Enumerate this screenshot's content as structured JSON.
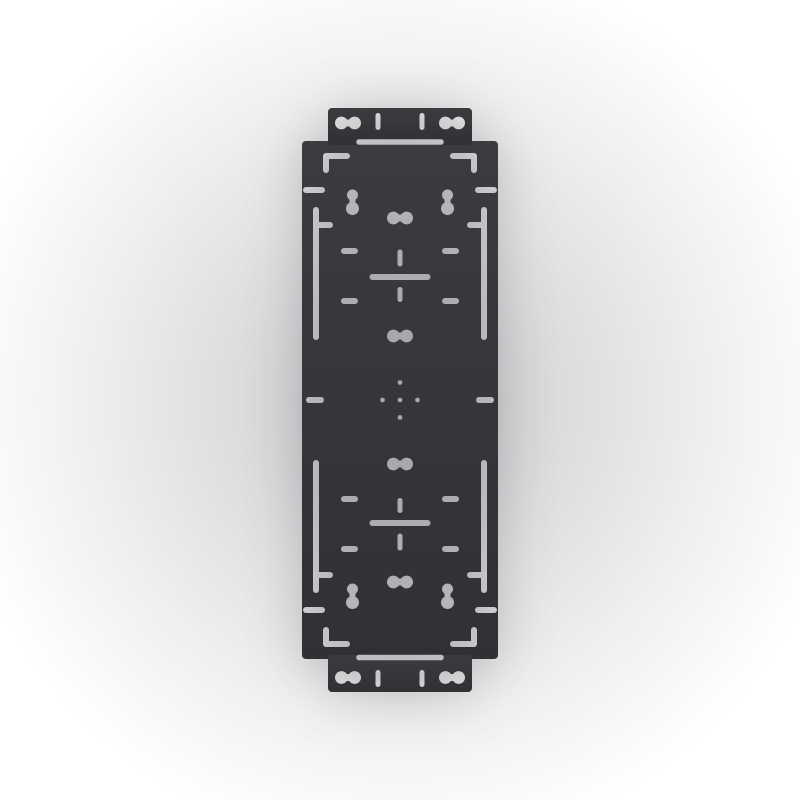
{
  "scene": {
    "description": "Product image of a dark gray rectangular mounting plate with narrow tabs at top and bottom, lying flat on a light studio backdrop; the plate has slotted dog-bone cutouts, keyhole slots, corner L-shaped marks, dashed alignment slots, two cross-shaped alignment cutouts and a central cluster of five small holes",
    "visible_text": ""
  },
  "colors": {
    "plate_top": "#3b3c40",
    "plate_bottom": "#303134",
    "backdrop_center": "#d0d1d2",
    "backdrop_edge": "#ffffff"
  },
  "plate": {
    "canvas": {
      "width": 800,
      "height": 800
    },
    "body": {
      "x": 302,
      "y": 141,
      "w": 196,
      "h": 518,
      "rx": 4
    },
    "tab_top": {
      "x": 328,
      "y": 108,
      "w": 144,
      "h": 37,
      "rx": 4
    },
    "tab_bottom": {
      "x": 328,
      "y": 655,
      "w": 144,
      "h": 37,
      "rx": 4
    },
    "hole_params": {
      "dogbone": {
        "span": 6.6,
        "r": 6.4,
        "neck": 7
      },
      "keyhole": {
        "r_top": 5.5,
        "r_bot": 6.5,
        "neck": 6
      }
    },
    "holes": [
      {
        "name": "tab-top-slot-left",
        "type": "dogbone-h",
        "cx": 348,
        "cy": 123
      },
      {
        "name": "tab-top-slot-right",
        "type": "dogbone-h",
        "cx": 452,
        "cy": 123
      },
      {
        "name": "tab-top-notch-left",
        "type": "line",
        "x1": 378,
        "y1": 115.5,
        "x2": 378,
        "y2": 127.5,
        "w": 5
      },
      {
        "name": "tab-top-notch-right",
        "type": "line",
        "x1": 422,
        "y1": 115.5,
        "x2": 422,
        "y2": 127.5,
        "w": 5
      },
      {
        "name": "top-junction-slot",
        "type": "line",
        "x1": 359,
        "y1": 142,
        "x2": 441,
        "y2": 142,
        "w": 5.5
      },
      {
        "name": "corner-mark-top-left",
        "type": "polyline",
        "points": [
          [
            347,
            156
          ],
          [
            326,
            156
          ],
          [
            326,
            170
          ]
        ],
        "w": 6
      },
      {
        "name": "corner-mark-top-right",
        "type": "polyline",
        "points": [
          [
            453,
            156
          ],
          [
            474,
            156
          ],
          [
            474,
            170
          ]
        ],
        "w": 6
      },
      {
        "name": "edge-dash-top-left",
        "type": "line",
        "x1": 306,
        "y1": 190,
        "x2": 322,
        "y2": 190,
        "w": 6
      },
      {
        "name": "edge-dash-top-right",
        "type": "line",
        "x1": 478,
        "y1": 190,
        "x2": 494,
        "y2": 190,
        "w": 6
      },
      {
        "name": "keyhole-top-left",
        "type": "keyhole",
        "cx": 352.5,
        "y_top": 195,
        "y_bot": 208.5
      },
      {
        "name": "keyhole-top-right",
        "type": "keyhole",
        "cx": 447.5,
        "y_top": 195,
        "y_bot": 208.5
      },
      {
        "name": "center-slot-1",
        "type": "dogbone-h",
        "cx": 400,
        "cy": 218
      },
      {
        "name": "side-slot-top-left",
        "type": "line",
        "x1": 316,
        "y1": 210,
        "x2": 316,
        "y2": 337,
        "w": 6
      },
      {
        "name": "side-slot-top-right",
        "type": "line",
        "x1": 484,
        "y1": 210,
        "x2": 484,
        "y2": 337,
        "w": 6
      },
      {
        "name": "side-branch-top-left",
        "type": "line",
        "x1": 316,
        "y1": 225,
        "x2": 330,
        "y2": 225,
        "w": 6
      },
      {
        "name": "side-branch-top-right",
        "type": "line",
        "x1": 470,
        "y1": 225,
        "x2": 484,
        "y2": 225,
        "w": 6
      },
      {
        "name": "dash-row1-left",
        "type": "line",
        "x1": 344,
        "y1": 251,
        "x2": 355,
        "y2": 251,
        "w": 6
      },
      {
        "name": "dash-row1-right",
        "type": "line",
        "x1": 445,
        "y1": 251,
        "x2": 456,
        "y2": 251,
        "w": 6
      },
      {
        "name": "cross-top-vertical-upper",
        "type": "line",
        "x1": 400,
        "y1": 252,
        "x2": 400,
        "y2": 264,
        "w": 5
      },
      {
        "name": "cross-top-horizontal",
        "type": "line",
        "x1": 372.5,
        "y1": 277,
        "x2": 427.5,
        "y2": 277,
        "w": 6
      },
      {
        "name": "cross-top-vertical-lower",
        "type": "line",
        "x1": 400,
        "y1": 289.5,
        "x2": 400,
        "y2": 299.5,
        "w": 5
      },
      {
        "name": "dash-row2-left",
        "type": "line",
        "x1": 344,
        "y1": 301,
        "x2": 355,
        "y2": 301,
        "w": 6
      },
      {
        "name": "dash-row2-right",
        "type": "line",
        "x1": 445,
        "y1": 301,
        "x2": 456,
        "y2": 301,
        "w": 6
      },
      {
        "name": "center-slot-2",
        "type": "dogbone-h",
        "cx": 400,
        "cy": 336
      },
      {
        "name": "edge-dash-mid-left",
        "type": "line",
        "x1": 309,
        "y1": 400,
        "x2": 321,
        "y2": 400,
        "w": 6
      },
      {
        "name": "edge-dash-mid-right",
        "type": "line",
        "x1": 479,
        "y1": 400,
        "x2": 491,
        "y2": 400,
        "w": 6
      },
      {
        "name": "center-dots",
        "type": "dots",
        "cx": 400,
        "cy": 400,
        "offset": 17.5,
        "r": 2.4
      },
      {
        "name": "center-slot-3",
        "type": "dogbone-h",
        "cx": 400,
        "cy": 464
      },
      {
        "name": "side-slot-bottom-left",
        "type": "line",
        "x1": 316,
        "y1": 463,
        "x2": 316,
        "y2": 590,
        "w": 6
      },
      {
        "name": "side-slot-bottom-right",
        "type": "line",
        "x1": 484,
        "y1": 463,
        "x2": 484,
        "y2": 590,
        "w": 6
      },
      {
        "name": "side-branch-bottom-left",
        "type": "line",
        "x1": 316,
        "y1": 575,
        "x2": 330,
        "y2": 575,
        "w": 6
      },
      {
        "name": "side-branch-bottom-right",
        "type": "line",
        "x1": 470,
        "y1": 575,
        "x2": 484,
        "y2": 575,
        "w": 6
      },
      {
        "name": "dash-row3-left",
        "type": "line",
        "x1": 344,
        "y1": 499,
        "x2": 355,
        "y2": 499,
        "w": 6
      },
      {
        "name": "dash-row3-right",
        "type": "line",
        "x1": 445,
        "y1": 499,
        "x2": 456,
        "y2": 499,
        "w": 6
      },
      {
        "name": "cross-bottom-vertical-upper",
        "type": "line",
        "x1": 400,
        "y1": 500.5,
        "x2": 400,
        "y2": 510.5,
        "w": 5
      },
      {
        "name": "cross-bottom-horizontal",
        "type": "line",
        "x1": 372.5,
        "y1": 523,
        "x2": 427.5,
        "y2": 523,
        "w": 6
      },
      {
        "name": "cross-bottom-vertical-lower",
        "type": "line",
        "x1": 400,
        "y1": 536,
        "x2": 400,
        "y2": 548,
        "w": 5
      },
      {
        "name": "dash-row4-left",
        "type": "line",
        "x1": 344,
        "y1": 549,
        "x2": 355,
        "y2": 549,
        "w": 6
      },
      {
        "name": "dash-row4-right",
        "type": "line",
        "x1": 445,
        "y1": 549,
        "x2": 456,
        "y2": 549,
        "w": 6
      },
      {
        "name": "center-slot-4",
        "type": "dogbone-h",
        "cx": 400,
        "cy": 582
      },
      {
        "name": "keyhole-bottom-left",
        "type": "keyhole",
        "cx": 352.5,
        "y_top": 589,
        "y_bot": 602.5
      },
      {
        "name": "keyhole-bottom-right",
        "type": "keyhole",
        "cx": 447.5,
        "y_top": 589,
        "y_bot": 602.5
      },
      {
        "name": "edge-dash-bottom-left",
        "type": "line",
        "x1": 306,
        "y1": 610,
        "x2": 322,
        "y2": 610,
        "w": 6
      },
      {
        "name": "edge-dash-bottom-right",
        "type": "line",
        "x1": 478,
        "y1": 610,
        "x2": 494,
        "y2": 610,
        "w": 6
      },
      {
        "name": "corner-mark-bottom-left",
        "type": "polyline",
        "points": [
          [
            347,
            644
          ],
          [
            326,
            644
          ],
          [
            326,
            630
          ]
        ],
        "w": 6
      },
      {
        "name": "corner-mark-bottom-right",
        "type": "polyline",
        "points": [
          [
            453,
            644
          ],
          [
            474,
            644
          ],
          [
            474,
            630
          ]
        ],
        "w": 6
      },
      {
        "name": "bottom-junction-slot",
        "type": "line",
        "x1": 359,
        "y1": 657.5,
        "x2": 441,
        "y2": 657.5,
        "w": 5.5
      },
      {
        "name": "tab-bottom-slot-left",
        "type": "dogbone-h",
        "cx": 348,
        "cy": 677.5
      },
      {
        "name": "tab-bottom-slot-right",
        "type": "dogbone-h",
        "cx": 452,
        "cy": 677.5
      },
      {
        "name": "tab-bottom-notch-left",
        "type": "line",
        "x1": 378,
        "y1": 672.5,
        "x2": 378,
        "y2": 684.5,
        "w": 5
      },
      {
        "name": "tab-bottom-notch-right",
        "type": "line",
        "x1": 422,
        "y1": 672.5,
        "x2": 422,
        "y2": 684.5,
        "w": 5
      }
    ]
  }
}
